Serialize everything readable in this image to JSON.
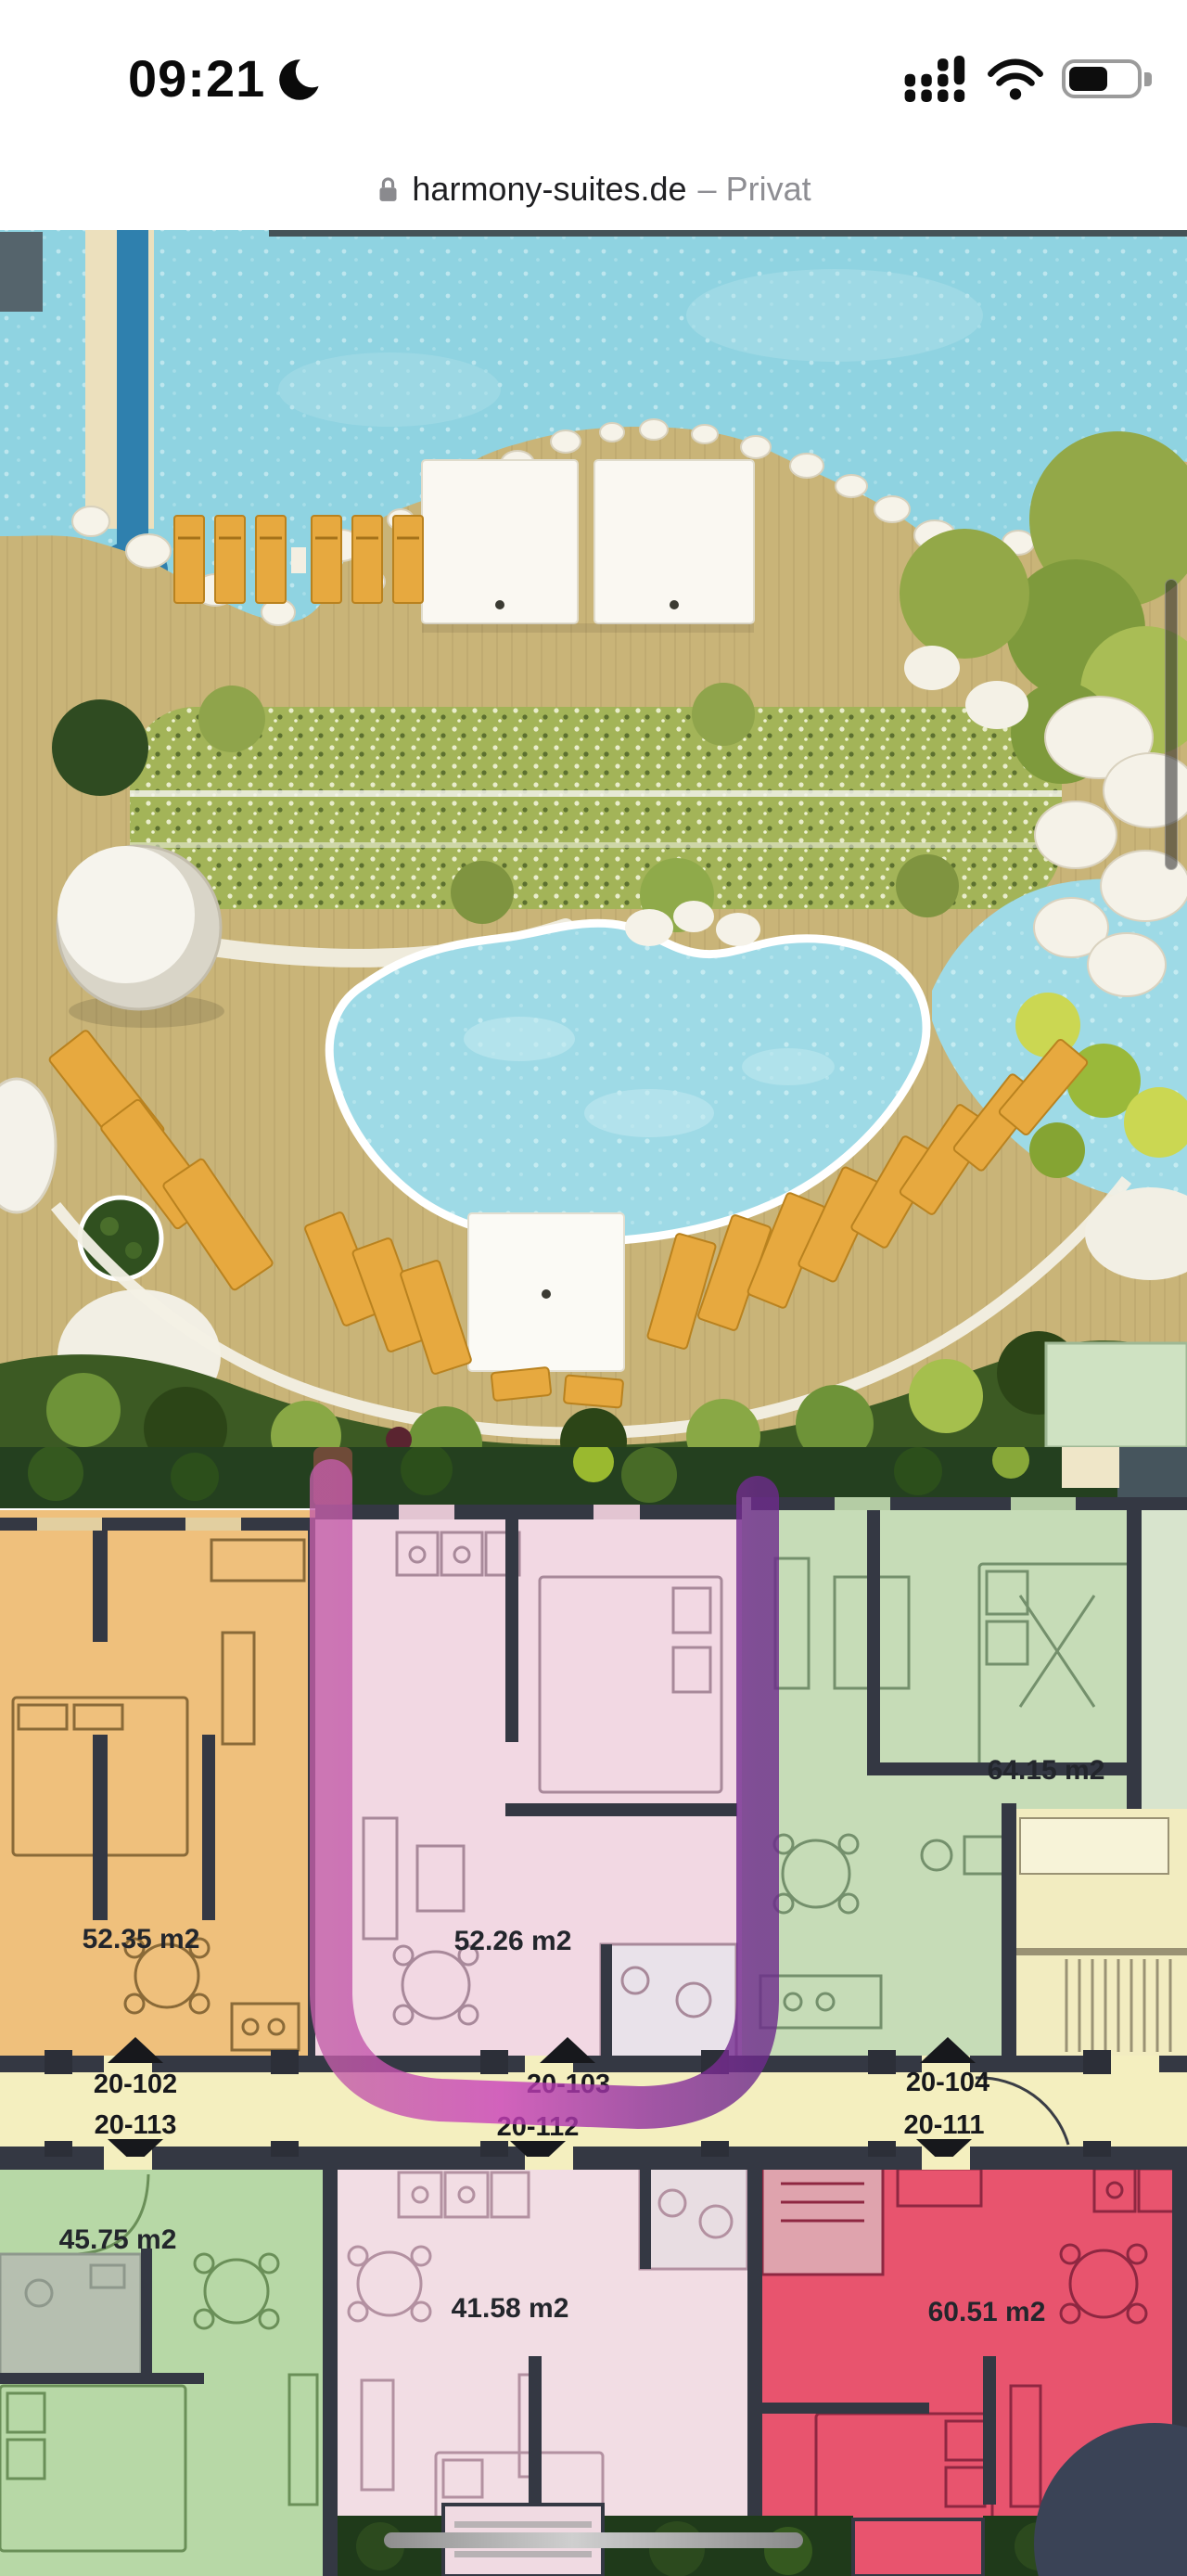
{
  "status_bar": {
    "time": "09:21",
    "focus_icon": "crescent-moon",
    "cellular_icon": "cellular-signal-dots",
    "wifi_icon": "wifi",
    "battery_icon": "battery",
    "battery_fill_ratio": 0.58
  },
  "address_bar": {
    "lock_icon": "padlock",
    "url": "harmony-suites.de",
    "privacy_suffix": "– Privat"
  },
  "site_plan": {
    "features": [
      "sea",
      "jetty",
      "beach-deck",
      "cabanas",
      "sun-loungers",
      "hedge",
      "dome-pavilion",
      "main-pool",
      "rock-garden",
      "lagoon",
      "foliage"
    ],
    "water_color": "#8fd3e1",
    "deck_color": "#c9b478",
    "pool_color": "#9edae6"
  },
  "floor_plan": {
    "units": [
      {
        "area_label": "52.35 m2",
        "fill": "#efc07c"
      },
      {
        "area_label": "52.26 m2",
        "fill": "#f2d8e3",
        "highlighted": true
      },
      {
        "area_label": "64.15 m2",
        "fill": "#c6dcb7"
      },
      {
        "area_label": "45.75 m2",
        "fill": "#b7d8a6"
      },
      {
        "area_label": "41.58 m2",
        "fill": "#f2dde4"
      },
      {
        "area_label": "60.51 m2",
        "fill": "#e8546e"
      }
    ],
    "corridor": {
      "top": [
        "20-102",
        "20-103",
        "20-104"
      ],
      "bottom": [
        "20-113",
        "20-112",
        "20-111"
      ]
    },
    "highlight_colors": {
      "left": "#c25da8",
      "mid": "#c93fbb",
      "right": "#6d2a8c"
    }
  }
}
